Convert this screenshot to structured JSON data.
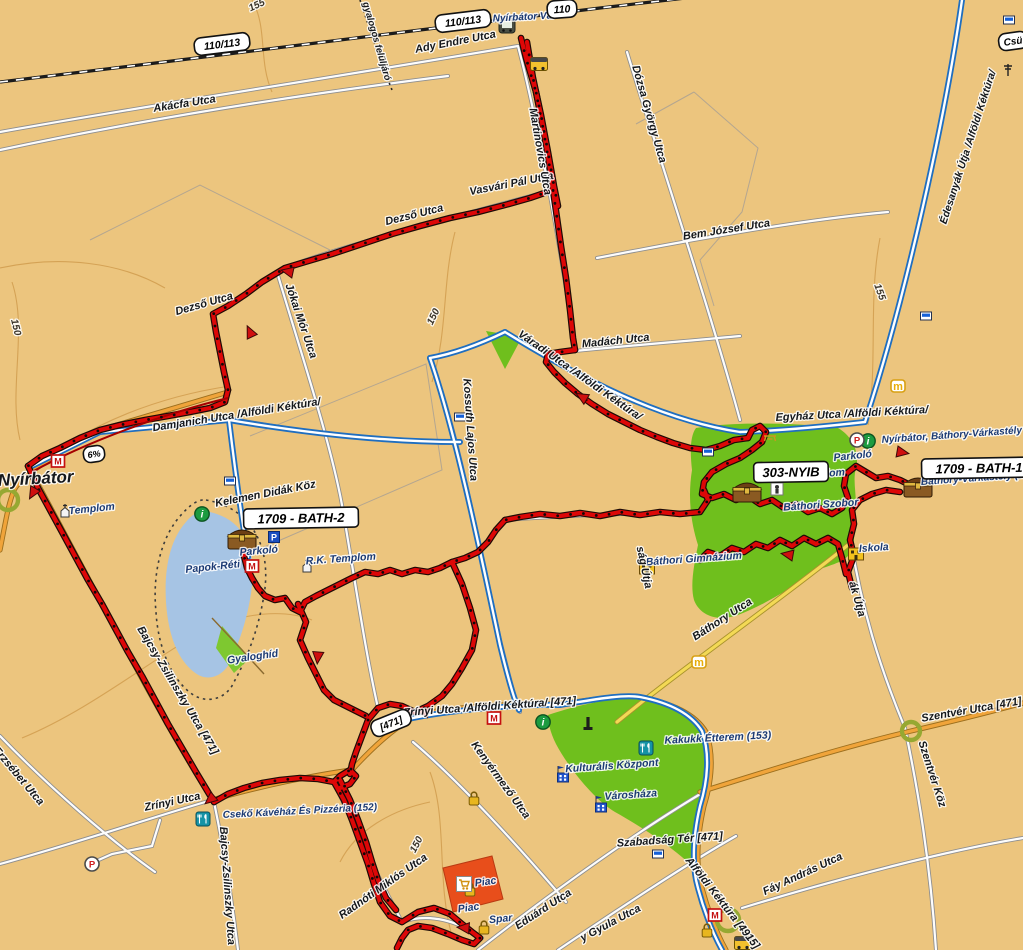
{
  "map": {
    "city": "Nyírbátor",
    "colors": {
      "background": "#ecc57e",
      "track_red": "#dd0707",
      "trail_blue": "#1f6ec0",
      "road_orange": "#f0a43a",
      "road_yellow": "#f3d955",
      "park_green": "#6fbf1d",
      "lake_blue": "#a6c4e4",
      "market_red": "#e84e1b",
      "contour_brown": "#cf9a4b"
    },
    "waypoints": [
      {
        "t": "1709 - BATH-2",
        "x": 301,
        "y": 518,
        "r": -1,
        "n": "waypoint-badge-bath2"
      },
      {
        "t": "303-NYIB",
        "x": 791,
        "y": 472,
        "r": -1,
        "n": "waypoint-badge-303nyib"
      },
      {
        "t": "1709 - BATH-1",
        "x": 979,
        "y": 468,
        "r": -1,
        "n": "waypoint-badge-bath1"
      }
    ],
    "road_badges": [
      {
        "t": "110/113",
        "x": 222,
        "y": 44,
        "r": -7,
        "s": 10.5,
        "n": "road-badge-110-113-west"
      },
      {
        "t": "110/113",
        "x": 463,
        "y": 21,
        "r": -7,
        "s": 10.5,
        "n": "road-badge-110-113-east"
      },
      {
        "t": "110",
        "x": 562,
        "y": 9,
        "r": -4,
        "s": 10.5,
        "n": "road-badge-110"
      },
      {
        "t": "Csü",
        "x": 1013,
        "y": 41,
        "r": -8,
        "s": 10,
        "n": "road-badge-csu"
      },
      {
        "t": "6%",
        "x": 94,
        "y": 454,
        "r": -8,
        "s": 9,
        "n": "grade-badge-6pct"
      },
      {
        "t": "[471]",
        "x": 391,
        "y": 723,
        "r": -22,
        "s": 10,
        "n": "road-badge-471"
      }
    ],
    "labels": [
      {
        "t": "Ady Endre Utca",
        "x": 456,
        "y": 45,
        "r": -11,
        "s": 11,
        "c": "st",
        "n": "street-ady-endre"
      },
      {
        "t": "Nyírbátor Vá.",
        "x": 524,
        "y": 20,
        "r": -3,
        "s": 10,
        "c": "poi",
        "n": "poi-nyirbator-va"
      },
      {
        "t": "gyalogos felüljáró",
        "x": 374,
        "y": 42,
        "r": 74,
        "s": 9.5,
        "c": "st",
        "n": "street-gyalogos-felujaro"
      },
      {
        "t": "Akácfa Utca",
        "x": 185,
        "y": 107,
        "r": -9,
        "s": 11,
        "c": "st",
        "n": "street-akacfa"
      },
      {
        "t": "Dózsa György Utca",
        "x": 646,
        "y": 115,
        "r": 74,
        "s": 11,
        "c": "st",
        "n": "street-dozsa-gyorgy"
      },
      {
        "t": "Bem József Utca",
        "x": 727,
        "y": 233,
        "r": -9,
        "s": 11,
        "c": "st",
        "n": "street-bem-jozsef"
      },
      {
        "t": "Édesanyák Útja /Alföldi Kéktúra/",
        "x": 971,
        "y": 148,
        "r": -72,
        "s": 10.5,
        "c": "st",
        "n": "street-edesanyak-utja"
      },
      {
        "t": "Dezső Utca",
        "x": 415,
        "y": 218,
        "r": -14,
        "s": 11,
        "c": "st",
        "n": "street-dezso-1"
      },
      {
        "t": "Vasvári Pál Utca",
        "x": 512,
        "y": 187,
        "r": -11,
        "s": 11,
        "c": "st",
        "n": "street-vasvari-pal"
      },
      {
        "t": "Dezső Utca",
        "x": 205,
        "y": 307,
        "r": -16,
        "s": 11,
        "c": "st",
        "n": "street-dezso-2"
      },
      {
        "t": "Jókai Mór Utca",
        "x": 298,
        "y": 322,
        "r": 71,
        "s": 11,
        "c": "st",
        "n": "street-jokai-mor"
      },
      {
        "t": "Martinovics Utca",
        "x": 537,
        "y": 152,
        "r": 80,
        "s": 11,
        "c": "st",
        "n": "street-martinovics"
      },
      {
        "t": "150",
        "x": 436,
        "y": 318,
        "r": -64,
        "s": 10,
        "c": "ct",
        "n": "contour-150-a"
      },
      {
        "t": "155",
        "x": 258,
        "y": 8,
        "r": -25,
        "s": 10,
        "c": "ct",
        "n": "contour-155-a"
      },
      {
        "t": "155",
        "x": 877,
        "y": 293,
        "r": 70,
        "s": 10,
        "c": "ct",
        "n": "contour-155-b"
      },
      {
        "t": "150",
        "x": 13,
        "y": 328,
        "r": 76,
        "s": 10,
        "c": "ct",
        "n": "contour-150-b"
      },
      {
        "t": "150",
        "x": 419,
        "y": 846,
        "r": -62,
        "s": 10,
        "c": "ct",
        "n": "contour-150-c"
      },
      {
        "t": "Madách Utca",
        "x": 616,
        "y": 344,
        "r": -6,
        "s": 11,
        "c": "st",
        "n": "street-madach"
      },
      {
        "t": "Váradi Utca /Alföldi Kéktúra/",
        "x": 578,
        "y": 378,
        "r": 35,
        "s": 11,
        "c": "st",
        "n": "street-varadi"
      },
      {
        "t": "Kossuth Lajos Utca",
        "x": 467,
        "y": 430,
        "r": 86,
        "s": 11,
        "c": "st",
        "n": "street-kossuth-lajos"
      },
      {
        "t": "Damjanich Utca /Alföldi Kéktúra/",
        "x": 237,
        "y": 418,
        "r": -9,
        "s": 11,
        "c": "st",
        "n": "street-damjanich"
      },
      {
        "t": "Egyház Utca /Alföldi Kéktúra/",
        "x": 852,
        "y": 417,
        "r": -3,
        "s": 11,
        "c": "st",
        "n": "street-egyhaz"
      },
      {
        "t": "Nyírbátor",
        "x": 36,
        "y": 484,
        "r": -3,
        "s": 17,
        "c": "city",
        "n": "city-label-nyirbator"
      },
      {
        "t": "Templom",
        "x": 92,
        "y": 512,
        "r": -6,
        "s": 10.5,
        "c": "poi",
        "n": "poi-templom-west"
      },
      {
        "t": "Kelemen Didák Köz",
        "x": 266,
        "y": 497,
        "r": -11,
        "s": 11,
        "c": "st",
        "n": "street-kelemen-didak"
      },
      {
        "t": "Parkoló",
        "x": 259,
        "y": 554,
        "r": -5,
        "s": 10.5,
        "c": "poi",
        "n": "poi-parkolo-lake"
      },
      {
        "t": "Papok-Réti",
        "x": 213,
        "y": 570,
        "r": -6,
        "s": 10.5,
        "c": "poi",
        "n": "poi-papok-reti"
      },
      {
        "t": "R.K. Templom",
        "x": 341,
        "y": 562,
        "r": -4,
        "s": 10.5,
        "c": "poi",
        "n": "poi-rk-templom"
      },
      {
        "t": "Gyaloghíd",
        "x": 253,
        "y": 660,
        "r": -8,
        "s": 10.5,
        "c": "poi",
        "n": "poi-gyaloghid"
      },
      {
        "t": "Nyírbátor, Báthory-Várkastély",
        "x": 952,
        "y": 438,
        "r": -4,
        "s": 10,
        "c": "poi",
        "n": "poi-varkastely-long"
      },
      {
        "t": "Parkoló",
        "x": 853,
        "y": 459,
        "r": -6,
        "s": 10.5,
        "c": "poi",
        "n": "poi-parkolo-castle"
      },
      {
        "t": "Templom",
        "x": 822,
        "y": 477,
        "r": -4,
        "s": 10.5,
        "c": "poi",
        "n": "poi-templom-castle"
      },
      {
        "t": "Báthori Szobor",
        "x": 821,
        "y": 508,
        "r": -4,
        "s": 10.5,
        "c": "poi",
        "n": "poi-bathori-szobor"
      },
      {
        "t": "Báthory-Várkastély (146",
        "x": 978,
        "y": 481,
        "r": -4,
        "s": 10,
        "c": "poi",
        "n": "poi-varkastely-146"
      },
      {
        "t": "Báthori Gimnázium",
        "x": 694,
        "y": 562,
        "r": -4,
        "s": 10.5,
        "c": "poi",
        "n": "poi-bathori-gimnazium"
      },
      {
        "t": "Iskola",
        "x": 874,
        "y": 551,
        "r": -4,
        "s": 10.5,
        "c": "poi",
        "n": "poi-iskola"
      },
      {
        "t": "ság Útja",
        "x": 641,
        "y": 568,
        "r": 78,
        "s": 11,
        "c": "st",
        "n": "street-sag-utja"
      },
      {
        "t": "ák Útja",
        "x": 854,
        "y": 600,
        "r": 74,
        "s": 11,
        "c": "st",
        "n": "street-ak-utja"
      },
      {
        "t": "Báthory Utca",
        "x": 724,
        "y": 622,
        "r": -33,
        "s": 11,
        "c": "st",
        "n": "street-bathory"
      },
      {
        "t": "Bajcsy-Zsilinszky Utca [471]",
        "x": 175,
        "y": 692,
        "r": 59,
        "s": 11,
        "c": "st",
        "n": "street-bajcsy-471"
      },
      {
        "t": "Erzsébet Utca",
        "x": 16,
        "y": 778,
        "r": 50,
        "s": 11,
        "c": "st",
        "n": "street-erzsebet"
      },
      {
        "t": "Zrínyi Utca",
        "x": 173,
        "y": 805,
        "r": -12,
        "s": 11,
        "c": "st",
        "n": "street-zrinyi-west"
      },
      {
        "t": "Bajcsy-Zsilinszky Utca",
        "x": 224,
        "y": 886,
        "r": 86,
        "s": 11,
        "c": "st",
        "n": "street-bajcsy-south"
      },
      {
        "t": "Zrínyi Utca /Alföldi Kéktúra/ [471]",
        "x": 490,
        "y": 710,
        "r": -4,
        "s": 11,
        "c": "st",
        "n": "street-zrinyi-kektura"
      },
      {
        "t": "Kenyérmező Utca",
        "x": 498,
        "y": 782,
        "r": 54,
        "s": 11,
        "c": "st",
        "n": "street-kenyermezo"
      },
      {
        "t": "Kakukk Étterem (153)",
        "x": 718,
        "y": 741,
        "r": -3,
        "s": 10.5,
        "c": "poi",
        "n": "poi-kakukk-etterem"
      },
      {
        "t": "Kulturális Központ",
        "x": 612,
        "y": 769,
        "r": -4,
        "s": 10.5,
        "c": "poi",
        "n": "poi-kulturalis-kozpont"
      },
      {
        "t": "Városháza",
        "x": 631,
        "y": 798,
        "r": -4,
        "s": 10.5,
        "c": "poi",
        "n": "poi-varoshaza"
      },
      {
        "t": "Szabadság Tér [471]",
        "x": 670,
        "y": 843,
        "r": -4,
        "s": 11,
        "c": "st",
        "n": "street-szabadsag-ter"
      },
      {
        "t": "Alföldi Kéktúra [4915]",
        "x": 720,
        "y": 905,
        "r": 52,
        "s": 11,
        "c": "st",
        "n": "street-alfoldi-kektura-4915"
      },
      {
        "t": "Fáy András Utca",
        "x": 804,
        "y": 877,
        "r": -25,
        "s": 11,
        "c": "st",
        "n": "street-fay-andras"
      },
      {
        "t": "Szentvér Utca [471]",
        "x": 972,
        "y": 713,
        "r": -10,
        "s": 11,
        "c": "st",
        "n": "street-szentver"
      },
      {
        "t": "Szentvér Köz",
        "x": 929,
        "y": 775,
        "r": 72,
        "s": 11,
        "c": "st",
        "n": "street-szentver-koz"
      },
      {
        "t": "Eduárd Utca",
        "x": 545,
        "y": 912,
        "r": -33,
        "s": 11,
        "c": "st",
        "n": "street-eduard"
      },
      {
        "t": "y Gyula Utca",
        "x": 612,
        "y": 926,
        "r": -28,
        "s": 11,
        "c": "st",
        "n": "street-gyula"
      },
      {
        "t": "Radnóti Miklós Utca",
        "x": 385,
        "y": 889,
        "r": -35,
        "s": 11,
        "c": "st",
        "n": "street-radnoti-miklos"
      },
      {
        "t": "Piac",
        "x": 486,
        "y": 885,
        "r": -8,
        "s": 10.5,
        "c": "poi",
        "n": "poi-piac-1"
      },
      {
        "t": "Piac",
        "x": 469,
        "y": 911,
        "r": -8,
        "s": 10.5,
        "c": "poi",
        "n": "poi-piac-2"
      },
      {
        "t": "Spar",
        "x": 501,
        "y": 922,
        "r": -6,
        "s": 10.5,
        "c": "poi",
        "n": "poi-spar"
      },
      {
        "t": "Csekő Kávéház És Pizzéria (152)",
        "x": 300,
        "y": 814,
        "r": -3,
        "s": 10,
        "c": "poi",
        "n": "poi-cseko-kavehaz"
      }
    ],
    "icons": [
      {
        "type": "train",
        "x": 507,
        "y": 26,
        "n": "train-station-icon"
      },
      {
        "type": "bus",
        "x": 539,
        "y": 64,
        "n": "bus-stop-icon"
      },
      {
        "type": "bus",
        "x": 743,
        "y": 943,
        "n": "bus-stop-icon"
      },
      {
        "type": "info",
        "x": 202,
        "y": 514,
        "n": "info-icon"
      },
      {
        "type": "info",
        "x": 543,
        "y": 722,
        "n": "info-icon"
      },
      {
        "type": "info",
        "x": 868,
        "y": 441,
        "n": "info-icon"
      },
      {
        "type": "pred",
        "x": 857,
        "y": 440,
        "n": "parking-icon"
      },
      {
        "type": "pred",
        "x": 92,
        "y": 864,
        "n": "parking-icon"
      },
      {
        "type": "pblue",
        "x": 274,
        "y": 537,
        "n": "parking-icon-blue"
      },
      {
        "type": "chest",
        "x": 242,
        "y": 539,
        "n": "geocache-chest-icon"
      },
      {
        "type": "chest",
        "x": 747,
        "y": 492,
        "n": "geocache-chest-icon"
      },
      {
        "type": "chest",
        "x": 918,
        "y": 487,
        "n": "geocache-chest-icon"
      },
      {
        "type": "museum",
        "x": 58,
        "y": 461,
        "n": "museum-icon"
      },
      {
        "type": "museum",
        "x": 252,
        "y": 566,
        "n": "museum-icon"
      },
      {
        "type": "museum",
        "x": 494,
        "y": 718,
        "n": "museum-icon"
      },
      {
        "type": "museum",
        "x": 715,
        "y": 915,
        "n": "museum-icon"
      },
      {
        "type": "church",
        "x": 65,
        "y": 512,
        "n": "church-icon"
      },
      {
        "type": "church",
        "x": 307,
        "y": 567,
        "n": "church-icon"
      },
      {
        "type": "church",
        "x": 798,
        "y": 477,
        "n": "church-icon"
      },
      {
        "type": "szobor",
        "x": 777,
        "y": 489,
        "n": "statue-icon"
      },
      {
        "type": "school",
        "x": 647,
        "y": 568,
        "n": "school-icon"
      },
      {
        "type": "school",
        "x": 856,
        "y": 554,
        "n": "school-icon"
      },
      {
        "type": "rest",
        "x": 646,
        "y": 748,
        "n": "restaurant-icon"
      },
      {
        "type": "rest",
        "x": 203,
        "y": 819,
        "n": "restaurant-icon"
      },
      {
        "type": "bldgflag",
        "x": 563,
        "y": 776,
        "n": "public-building-icon"
      },
      {
        "type": "bldgflag",
        "x": 601,
        "y": 806,
        "n": "public-building-icon"
      },
      {
        "type": "monument",
        "x": 588,
        "y": 726,
        "n": "monument-icon"
      },
      {
        "type": "padlock",
        "x": 474,
        "y": 799,
        "n": "padlock-icon"
      },
      {
        "type": "padlock",
        "x": 470,
        "y": 890,
        "n": "padlock-icon"
      },
      {
        "type": "padlock",
        "x": 484,
        "y": 928,
        "n": "padlock-icon"
      },
      {
        "type": "padlock",
        "x": 707,
        "y": 931,
        "n": "padlock-icon"
      },
      {
        "type": "cart",
        "x": 464,
        "y": 884,
        "n": "shopping-cart-icon"
      },
      {
        "type": "micon",
        "x": 898,
        "y": 386,
        "n": "m-marker-icon"
      },
      {
        "type": "micon",
        "x": 699,
        "y": 662,
        "n": "m-marker-icon"
      },
      {
        "type": "blaze",
        "x": 230,
        "y": 481,
        "n": "trail-blaze-icon"
      },
      {
        "type": "blaze",
        "x": 460,
        "y": 417,
        "n": "trail-blaze-icon"
      },
      {
        "type": "blaze",
        "x": 708,
        "y": 452,
        "n": "trail-blaze-icon"
      },
      {
        "type": "blaze",
        "x": 926,
        "y": 316,
        "n": "trail-blaze-icon"
      },
      {
        "type": "blaze",
        "x": 1009,
        "y": 20,
        "n": "trail-blaze-icon"
      },
      {
        "type": "blaze",
        "x": 658,
        "y": 854,
        "n": "trail-blaze-icon"
      },
      {
        "type": "picnic",
        "x": 770,
        "y": 437,
        "n": "picnic-table-icon"
      },
      {
        "type": "signpost",
        "x": 1008,
        "y": 70,
        "n": "signpost-icon"
      }
    ]
  }
}
